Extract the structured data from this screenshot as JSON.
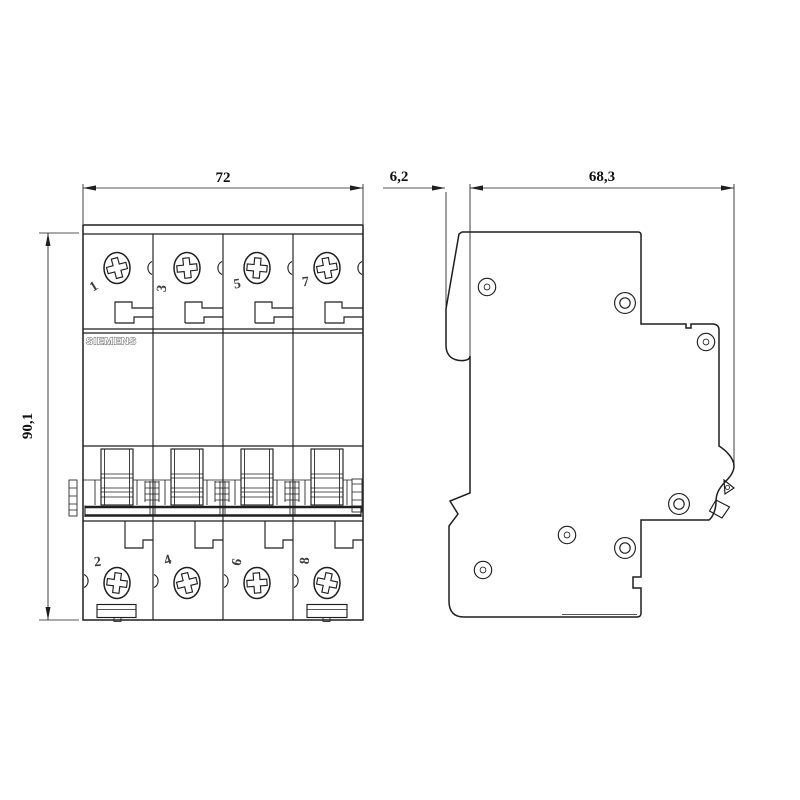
{
  "drawing": {
    "background_color": "#ffffff",
    "line_color": "#1f1f1f",
    "brand_label": "SIEMENS",
    "dimensions": {
      "front_width": "72",
      "front_height": "90,1",
      "side_front_offset": "6,2",
      "side_depth": "68,3"
    },
    "front_view": {
      "pole_numbers_top": [
        "1",
        "3",
        "5",
        "7"
      ],
      "pole_numbers_bottom": [
        "2",
        "4",
        "6",
        "8"
      ]
    }
  }
}
